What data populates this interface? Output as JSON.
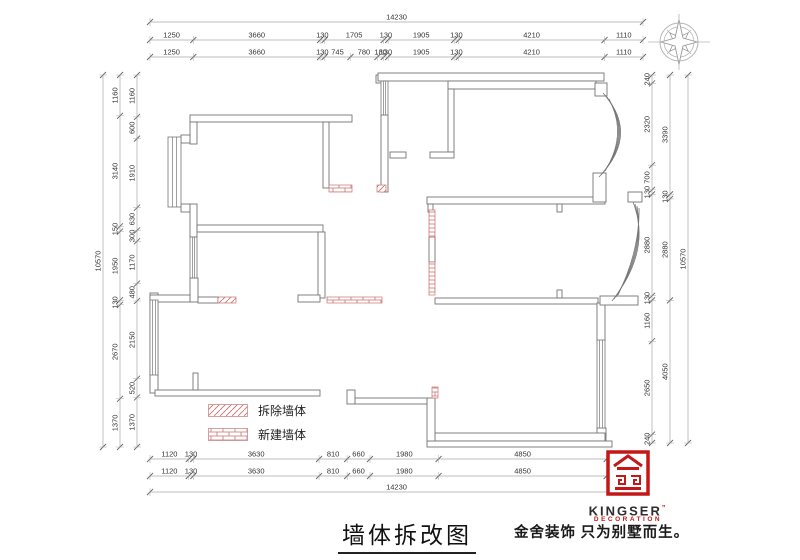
{
  "title": {
    "text": "墙体拆改图"
  },
  "legend": {
    "demolish": "拆除墙体",
    "new": "新建墙体"
  },
  "branding": {
    "name": "KINGSER",
    "reg": "”",
    "sub": "DECORATION",
    "slogan": "金舍装饰 只为别墅而生。"
  },
  "colors": {
    "wall": "#757575",
    "dim_line": "#a8a8a8",
    "dim_text": "#333333",
    "red_pattern": "#cc7070",
    "brand_red": "#c41818",
    "compass": "#b5b5b5"
  },
  "dims": [
    {
      "d": "h",
      "p": 22,
      "a": 150,
      "b": 643,
      "v": [
        14230
      ]
    },
    {
      "d": "h",
      "p": 40,
      "a": 150,
      "b": 643,
      "v": [
        1250,
        3660,
        130,
        1705,
        130,
        1905,
        130,
        4210,
        1110
      ]
    },
    {
      "d": "h",
      "p": 57,
      "a": 150,
      "b": 643,
      "v": [
        1250,
        3660,
        130,
        745,
        780,
        180,
        130,
        1905,
        130,
        4210,
        1110
      ]
    },
    {
      "d": "h",
      "p": 459,
      "a": 150,
      "b": 643,
      "v": [
        1120,
        130,
        3630,
        810,
        660,
        1980,
        4850,
        1050
      ]
    },
    {
      "d": "h",
      "p": 476,
      "a": 150,
      "b": 643,
      "v": [
        1120,
        130,
        3630,
        810,
        660,
        1980,
        4850,
        1050
      ]
    },
    {
      "d": "h",
      "p": 492,
      "a": 150,
      "b": 643,
      "v": [
        14230
      ]
    },
    {
      "d": "v",
      "p": 103,
      "a": 75,
      "b": 447,
      "v": [
        10570
      ]
    },
    {
      "d": "v",
      "p": 120,
      "a": 75,
      "b": 447,
      "v": [
        1160,
        3140,
        150,
        1950,
        130,
        2670,
        1370
      ]
    },
    {
      "d": "v",
      "p": 137,
      "a": 75,
      "b": 447,
      "v": [
        1160,
        600,
        1910,
        630,
        300,
        1170,
        480,
        2150,
        520,
        1370
      ]
    },
    {
      "d": "v",
      "p": 652,
      "a": 75,
      "b": 443,
      "v": [
        240,
        2320,
        700,
        130,
        2880,
        130,
        1160,
        2650,
        240
      ]
    },
    {
      "d": "v",
      "p": 670,
      "a": 75,
      "b": 443,
      "v": [
        3390,
        130,
        2880,
        4050
      ]
    },
    {
      "d": "v",
      "p": 688,
      "a": 75,
      "b": 443,
      "v": [
        10570
      ]
    }
  ],
  "plan": {
    "walls": [
      [
        190,
        115,
        162,
        7
      ],
      [
        190,
        122,
        7,
        22
      ],
      [
        181,
        135,
        9,
        8
      ],
      [
        181,
        204,
        9,
        8
      ],
      [
        190,
        204,
        7,
        33
      ],
      [
        190,
        278,
        8,
        24
      ],
      [
        150,
        293,
        8,
        100
      ],
      [
        150,
        295,
        40,
        7
      ],
      [
        198,
        297,
        20,
        6
      ],
      [
        155,
        390,
        165,
        6
      ],
      [
        193,
        373,
        5,
        17
      ],
      [
        197,
        225,
        126,
        7
      ],
      [
        318,
        232,
        7,
        66
      ],
      [
        298,
        295,
        22,
        7
      ],
      [
        323,
        122,
        6,
        66
      ],
      [
        376,
        75,
        11,
        8
      ],
      [
        378,
        73,
        226,
        8
      ],
      [
        381,
        115,
        7,
        77
      ],
      [
        448,
        81,
        148,
        8
      ],
      [
        448,
        89,
        6,
        63
      ],
      [
        430,
        152,
        24,
        6
      ],
      [
        390,
        152,
        16,
        6
      ],
      [
        427,
        197,
        178,
        7
      ],
      [
        428,
        204,
        5,
        8
      ],
      [
        557,
        204,
        5,
        8
      ],
      [
        595,
        83,
        12,
        13
      ],
      [
        593,
        173,
        13,
        29
      ],
      [
        628,
        192,
        14,
        10
      ],
      [
        435,
        298,
        163,
        6
      ],
      [
        557,
        290,
        5,
        8
      ],
      [
        597,
        303,
        8,
        38
      ],
      [
        597,
        428,
        9,
        13
      ],
      [
        600,
        296,
        38,
        9
      ],
      [
        435,
        433,
        170,
        8
      ],
      [
        427,
        441,
        185,
        6
      ],
      [
        427,
        398,
        8,
        43
      ],
      [
        355,
        398,
        72,
        6
      ],
      [
        347,
        390,
        8,
        14
      ],
      [
        429,
        237,
        6,
        25
      ]
    ],
    "windows": [
      [
        168,
        137,
        13,
        70
      ],
      [
        190,
        237,
        7,
        41
      ],
      [
        150,
        300,
        8,
        75
      ],
      [
        381,
        81,
        7,
        34
      ],
      [
        597,
        340,
        8,
        88
      ]
    ],
    "bricks": [
      [
        329,
        185,
        23,
        7
      ],
      [
        327,
        297,
        55,
        6
      ],
      [
        429,
        210,
        6,
        27
      ],
      [
        429,
        262,
        6,
        33
      ],
      [
        432,
        387,
        6,
        11
      ]
    ],
    "hatches": [
      [
        218,
        297,
        18,
        6
      ],
      [
        377,
        185,
        9,
        7
      ]
    ],
    "curves": [
      "M603,93 Q640,134 599,177",
      "M605,95 Q636,134 601,175",
      "M607,97 Q632,134 603,173",
      "M609,99 Q628,134 605,171",
      "M633,202 Q652,250 612,301",
      "M635,204 Q648,250 614,299",
      "M637,206 Q644,250 616,297",
      "M639,208 Q640,250 618,295"
    ],
    "compass": {
      "cx": 679,
      "cy": 42,
      "r_outer": 19,
      "r_inner": 15
    }
  }
}
